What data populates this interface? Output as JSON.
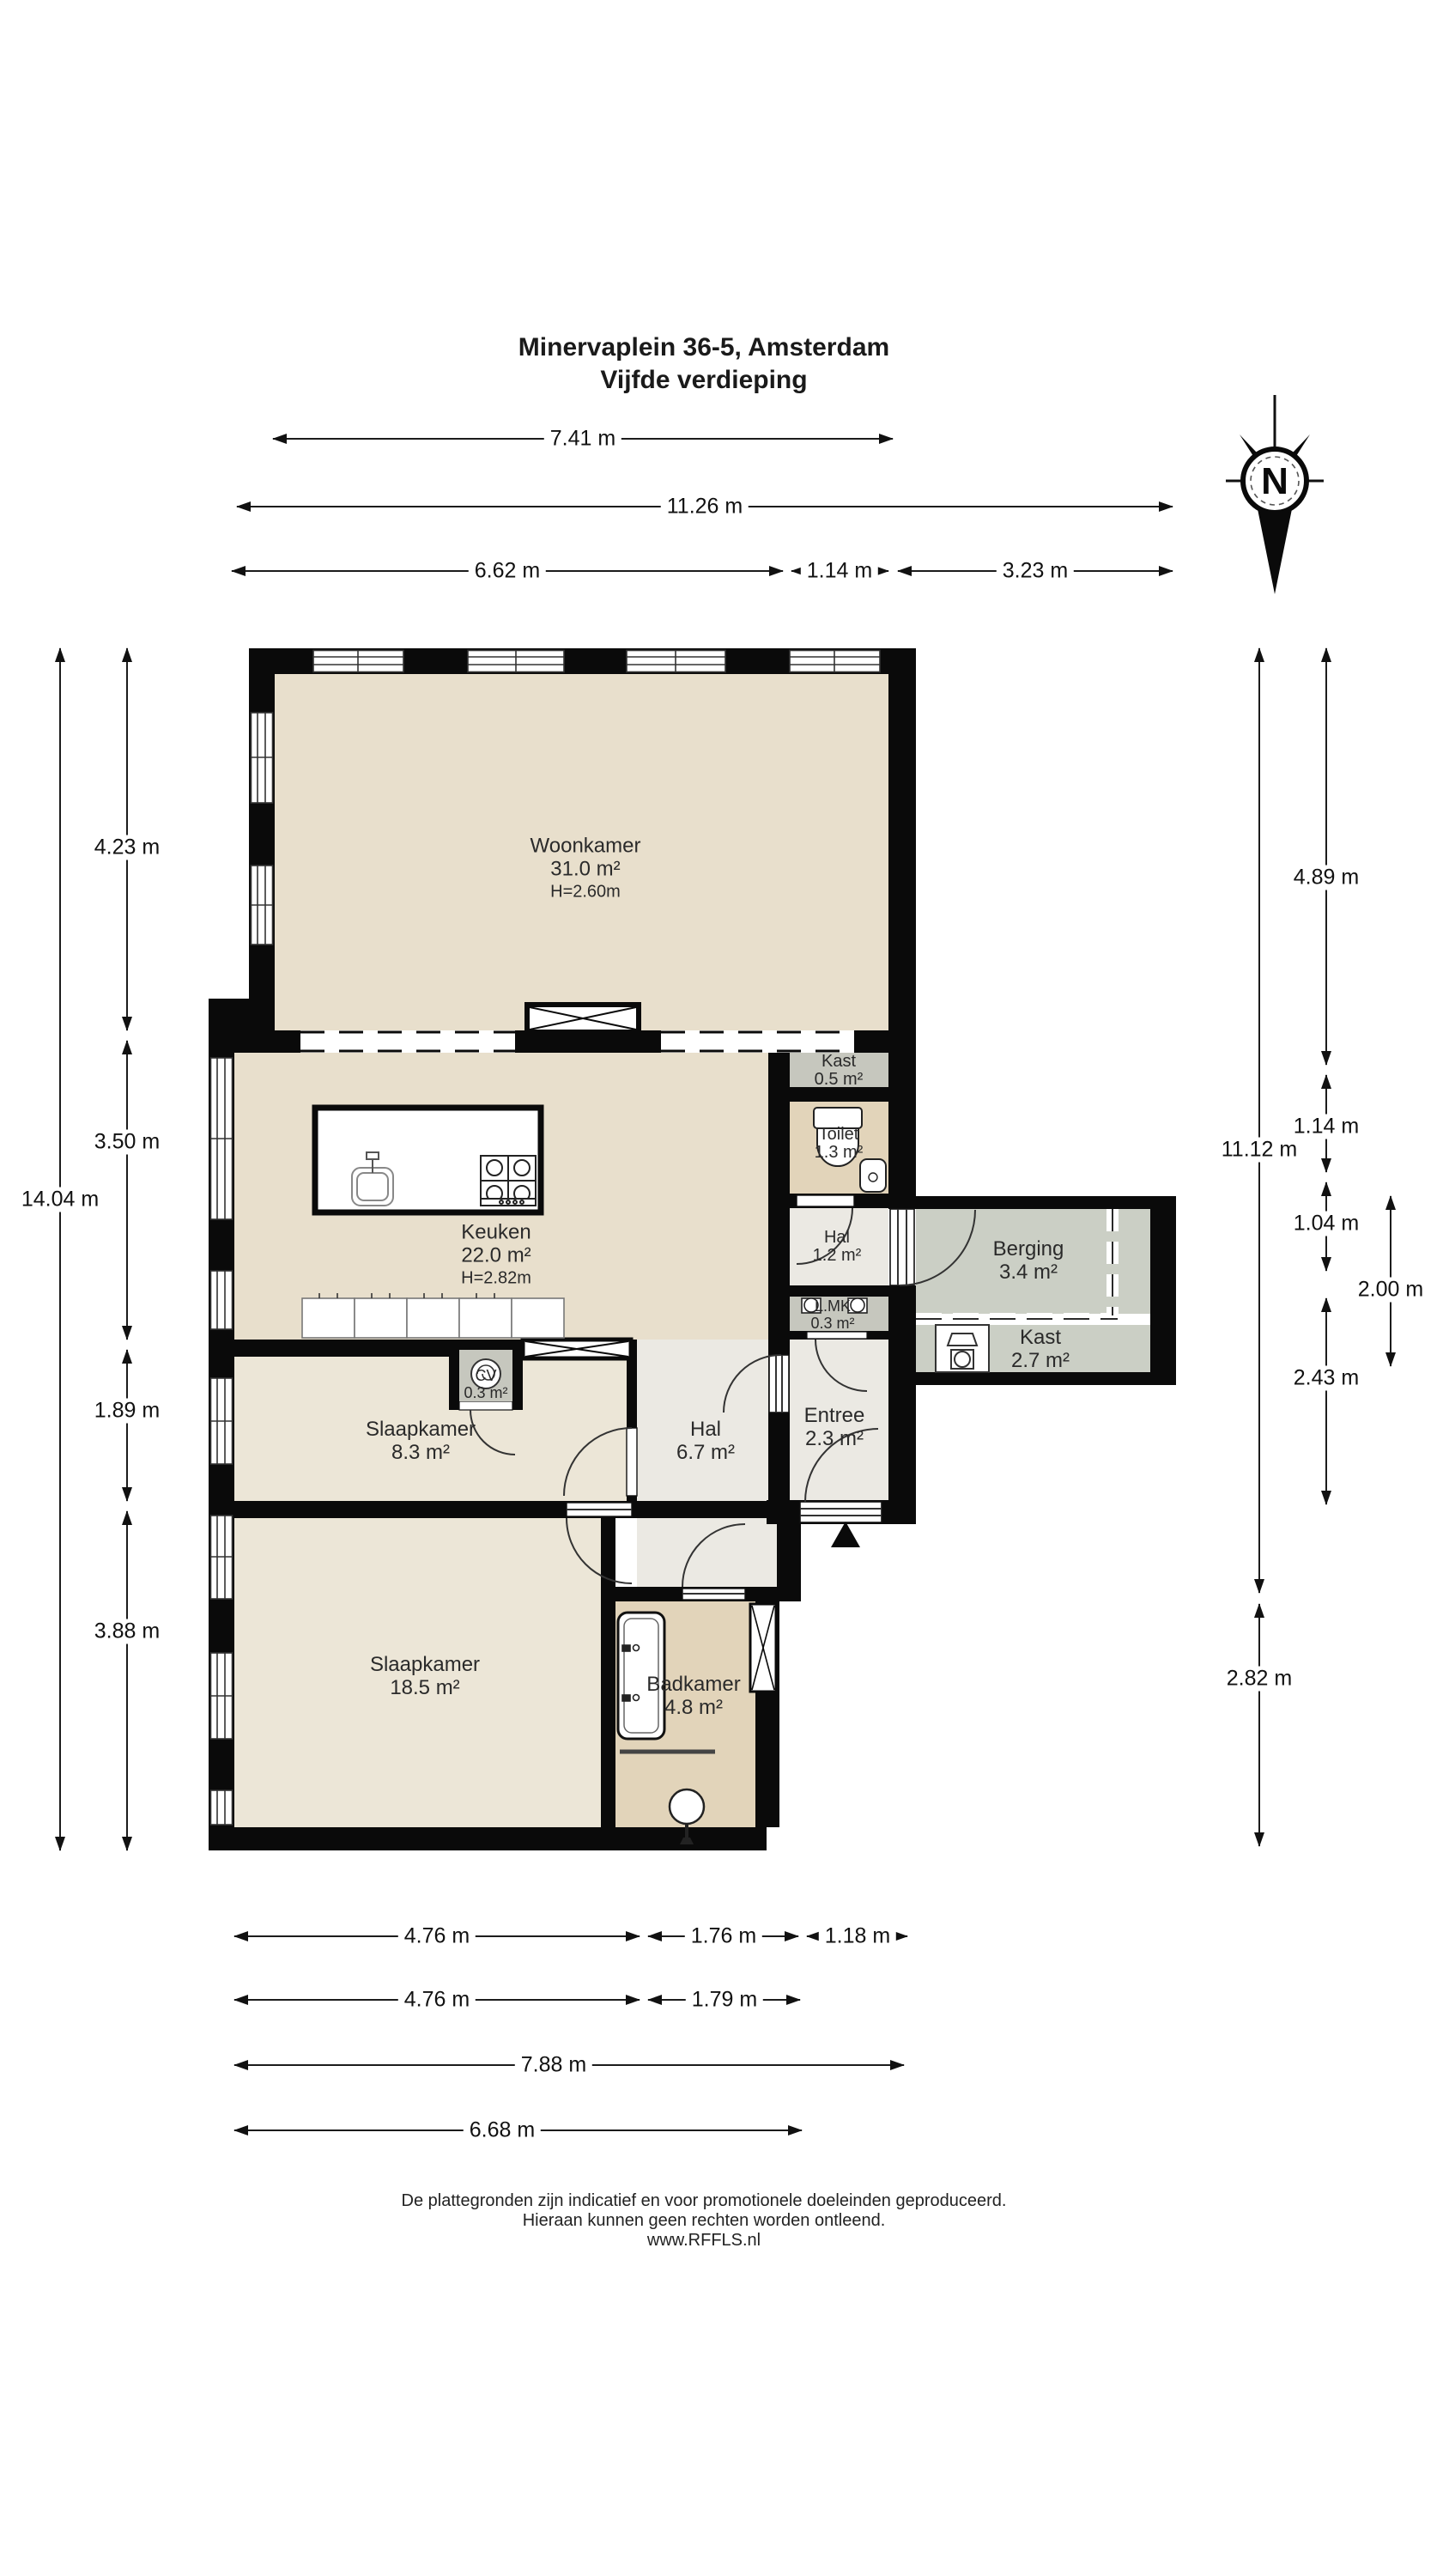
{
  "title": {
    "line1": "Minervaplein 36-5, Amsterdam",
    "line2": "Vijfde verdieping"
  },
  "compass": {
    "label": "N"
  },
  "rooms": {
    "woonkamer": {
      "name": "Woonkamer",
      "area": "31.0 m²",
      "height": "H=2.60m"
    },
    "keuken": {
      "name": "Keuken",
      "area": "22.0 m²",
      "height": "H=2.82m"
    },
    "kast_klein": {
      "name": "Kast",
      "area": "0.5 m²"
    },
    "toilet": {
      "name": "Toilet",
      "area": "1.3 m²"
    },
    "hal_klein": {
      "name": "Hal",
      "area": "1.2 m²"
    },
    "berging": {
      "name": "Berging",
      "area": "3.4 m²"
    },
    "kast_groot": {
      "name": "Kast",
      "area": "2.7 m²"
    },
    "lmk": {
      "name": "L.MK",
      "area": "0.3 m²"
    },
    "cv": {
      "name": "CV",
      "area": "0.3 m²"
    },
    "slaapkamer_klein": {
      "name": "Slaapkamer",
      "area": "8.3 m²"
    },
    "hal_groot": {
      "name": "Hal",
      "area": "6.7 m²"
    },
    "entree": {
      "name": "Entree",
      "area": "2.3 m²"
    },
    "slaapkamer_groot": {
      "name": "Slaapkamer",
      "area": "18.5 m²"
    },
    "badkamer": {
      "name": "Badkamer",
      "area": "4.8 m²"
    }
  },
  "dimensions": {
    "top": [
      "7.41 m",
      "11.26 m",
      "6.62 m",
      "1.14 m",
      "3.23 m"
    ],
    "left": [
      "4.23 m",
      "3.50 m",
      "1.89 m",
      "3.88 m",
      "14.04 m"
    ],
    "right": [
      "4.89 m",
      "1.14 m",
      "1.04 m",
      "2.43 m",
      "11.12 m",
      "2.82 m",
      "2.00 m"
    ],
    "bottom": [
      "4.76 m",
      "1.76 m",
      "1.18 m",
      "4.76 m",
      "1.79 m",
      "7.88 m",
      "6.68 m"
    ]
  },
  "footer": {
    "line1": "De plattegronden zijn indicatief en voor promotionele doeleinden geproduceerd.",
    "line2": "Hieraan kunnen geen rechten worden ontleend.",
    "line3": "www.RFFLS.nl"
  },
  "colors": {
    "floor_living": "#e8dfcc",
    "floor_bedroom": "#ece6d7",
    "floor_wet": "#e2d4ba",
    "floor_hall": "#ebe9e3",
    "floor_closet": "#c6c7be",
    "floor_storage": "#cbcfc5",
    "wall": "#0a0a0a",
    "dimension_line": "#1c1c1c"
  }
}
